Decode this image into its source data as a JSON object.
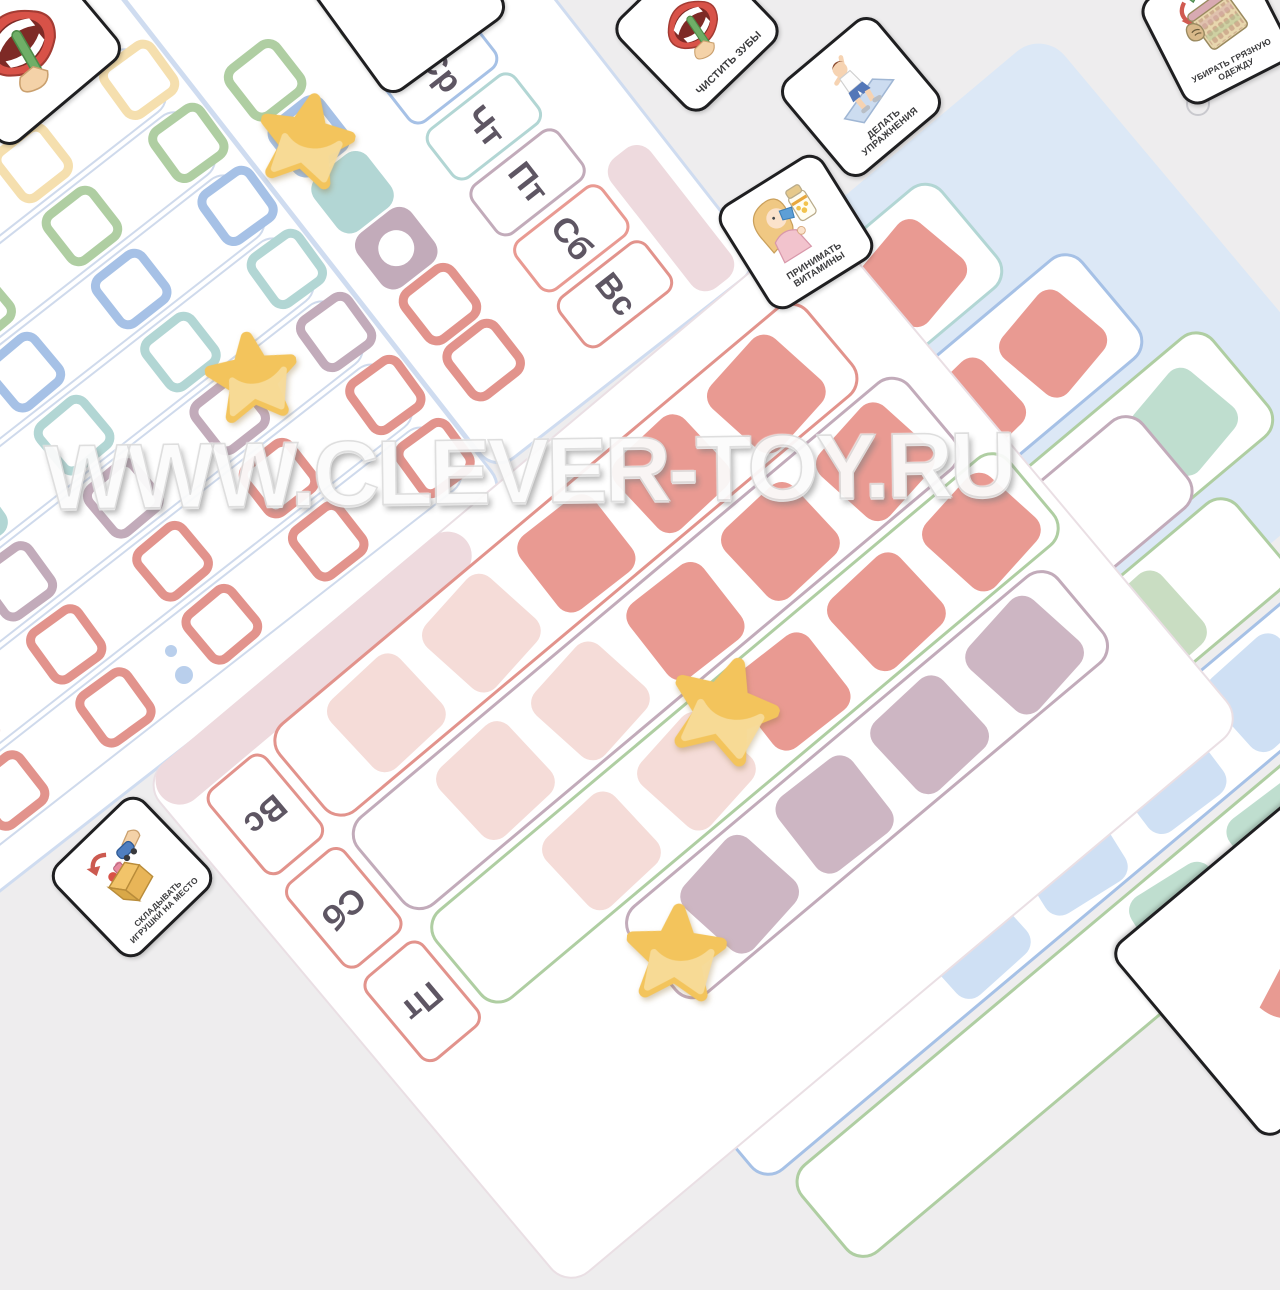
{
  "watermark": {
    "text": "WWW.CLEVER-TOY.RU"
  },
  "cards": {
    "brush_teeth": {
      "label": "ЧИСТИТЬ ЗУБЫ"
    },
    "exercise": {
      "label": "ДЕЛАТЬ УПРАЖНЕНИЯ"
    },
    "vitamins": {
      "label": "ПРИНИМАТЬ ВИТАМИНЫ"
    },
    "laundry": {
      "label": "УБИРАТЬ ГРЯЗНУЮ ОДЕЖДУ"
    },
    "toys": {
      "label": "СКЛАДЫВАТЬ ИГРУШКИ НА МЕСТО"
    },
    "comb_hair": {
      "label": "ЧЕСЫВАТЬСЯ"
    }
  },
  "week_board": {
    "days": [
      {
        "label": "Вт",
        "color": "green"
      },
      {
        "label": "Ср",
        "color": "blue"
      },
      {
        "label": "Чт",
        "color": "teal"
      },
      {
        "label": "Пт",
        "color": "mauve"
      },
      {
        "label": "Сб",
        "color": "salmon"
      },
      {
        "label": "Вс",
        "color": "red"
      }
    ],
    "task_cells": [
      {
        "color": "green",
        "fill": false,
        "circle": false
      },
      {
        "color": "blue",
        "fill": false,
        "circle": false
      },
      {
        "color": "teal",
        "fill": true,
        "circle": false
      },
      {
        "color": "mauve",
        "fill": true,
        "circle": true
      },
      {
        "color": "red",
        "fill": false,
        "circle": false
      },
      {
        "color": "red",
        "fill": false,
        "circle": false
      }
    ]
  },
  "tracker_board": {
    "rows": [
      "yellow",
      "green",
      "blue",
      "teal",
      "mauve",
      "red",
      "red"
    ]
  },
  "right_board": {
    "strips": [
      {
        "border": "teal",
        "cells": [
          "salmon",
          "salmon",
          "mint",
          "mint",
          "mint",
          "mint"
        ]
      },
      {
        "border": "blue",
        "cells": [
          "salmon",
          "salmon",
          "lightblue",
          "lightblue",
          "lightblue",
          "lightblue"
        ]
      },
      {
        "border": "green",
        "cells": [
          "mint",
          "mint",
          "lightblue",
          "mint"
        ]
      }
    ]
  },
  "bottom_board": {
    "days": [
      "Вс",
      "Сб",
      "Пт"
    ],
    "strips": [
      {
        "border": "red",
        "cells": [
          "salmon",
          "salmon",
          "salmon",
          "palepink",
          "palepink"
        ]
      },
      {
        "border": "mauve",
        "cells": [
          "salmon",
          "salmon",
          "salmon",
          "palepink",
          "palepink"
        ]
      },
      {
        "border": "green",
        "cells": [
          "salmon",
          "salmon",
          "salmon",
          "palepink",
          "palepink"
        ]
      },
      {
        "border": "mauve",
        "cells": [
          "dusty",
          "dusty",
          "dusty",
          "dusty"
        ]
      }
    ]
  },
  "underlay_board": {
    "strips": [
      {
        "border": "mauve",
        "cells": [
          "dusty",
          "dusty",
          "dusty"
        ]
      },
      {
        "border": "green",
        "cells": [
          "sage",
          "sage",
          "sage",
          "sage",
          "sage"
        ]
      },
      {
        "border": "blue",
        "cells": [
          "lightblue",
          "lightblue",
          "lightblue",
          "lightblue"
        ]
      },
      {
        "border": "green",
        "cells": [
          "mint",
          "mint",
          "mint"
        ]
      }
    ]
  },
  "tokens": {
    "star_count": 4
  },
  "palette": {
    "yellow": "#f5dfae",
    "green": "#afcea2",
    "blue": "#a6c1e6",
    "teal": "#b2d6d4",
    "mauve": "#c2abba",
    "red": "#e2938c",
    "salmon": "#e99a92",
    "palepink": "#f5dcd8",
    "dusty": "#cdb6c3",
    "sage": "#c9ddc2",
    "mint": "#bfdecf",
    "lightblue": "#cfe0f4",
    "star": "#f3c45c",
    "star_light": "#f8dc99",
    "backing": "#dce8f6",
    "strip_edge": "#cfdaec",
    "board_edge": "#cfdcf0",
    "pink_edge": "#eedade",
    "label_text": "#5e5663",
    "card_border": "#1f1f21",
    "background": "#eeedee"
  }
}
